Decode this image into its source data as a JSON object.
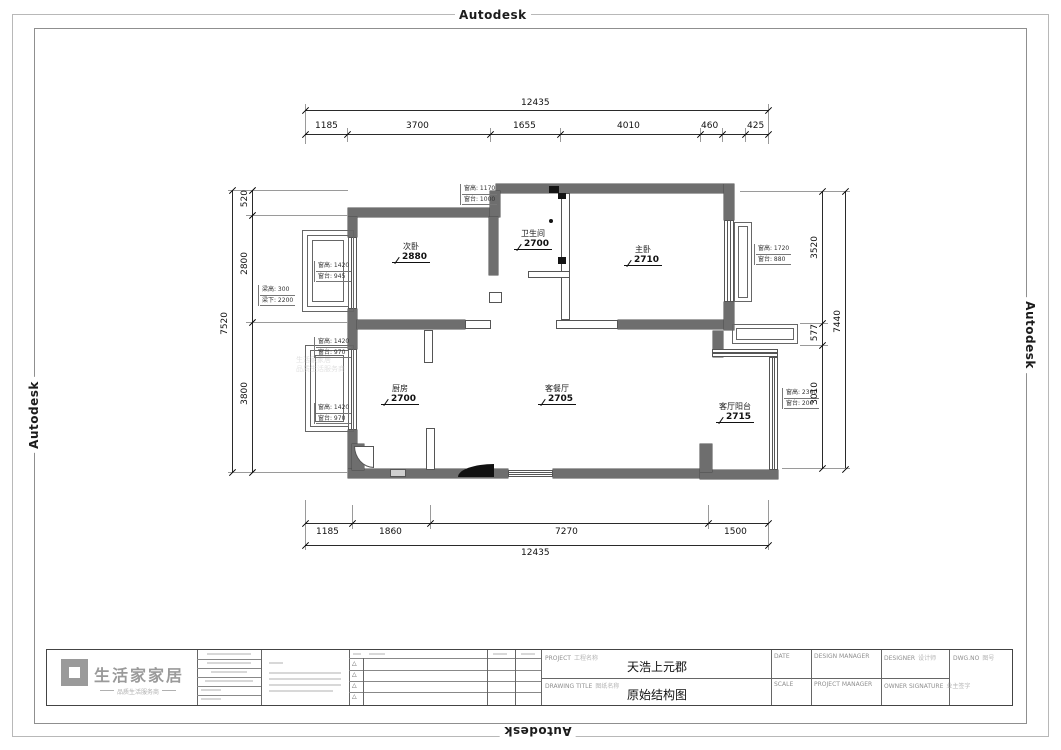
{
  "watermark_text": "Autodesk",
  "plan": {
    "rooms": [
      {
        "name": "次卧",
        "height": "2880"
      },
      {
        "name": "卫生间",
        "height": "2700"
      },
      {
        "name": "主卧",
        "height": "2710"
      },
      {
        "name": "厨房",
        "height": "2700"
      },
      {
        "name": "客餐厅",
        "height": "2705"
      },
      {
        "name": "客厅阳台",
        "height": "2715"
      }
    ],
    "dims": {
      "top": {
        "overall": "12435",
        "segments": [
          "1185",
          "3700",
          "1655",
          "4010",
          "460",
          "425"
        ]
      },
      "bottom": {
        "overall": "12435",
        "segments": [
          "1185",
          "1860",
          "7270",
          "1500"
        ]
      },
      "left": {
        "overall": "7520",
        "segments": [
          "520",
          "2800",
          "3800"
        ]
      },
      "right": {
        "overall": "7440",
        "segments": [
          "3520",
          "577",
          "3010"
        ]
      }
    },
    "annotations": [
      {
        "line1": "窗高: 1170",
        "line2": "窗台: 1000"
      },
      {
        "line1": "窗高: 1420",
        "line2": "窗台: 945"
      },
      {
        "line1": "梁高: 300",
        "line2": "梁下: 2200"
      },
      {
        "line1": "窗高: 1420",
        "line2": "窗台: 970"
      },
      {
        "line1": "窗高: 1420",
        "line2": "窗台: 970"
      },
      {
        "line1": "窗高: 1720",
        "line2": "窗台: 880"
      },
      {
        "line1": "窗高: 2300",
        "line2": "窗台: 200"
      }
    ]
  },
  "title_block": {
    "logo": {
      "name": "生活家家居",
      "tagline": "品质生活服务商"
    },
    "project_label": "PROJECT",
    "project_label_cn": "工程名称",
    "project_value": "天浩上元郡",
    "drawing_title_label": "DRAWING TITLE",
    "drawing_title_label_cn": "图纸名称",
    "drawing_title_value": "原始结构图",
    "date_label": "DATE",
    "design_manager_label": "DESIGN MANAGER",
    "designer_label": "DESIGNER",
    "designer_label_cn": "设计师",
    "scale_label": "SCALE",
    "project_manager_label": "PROJECT MANAGER",
    "owner_signature_label": "OWNER SIGNATURE",
    "owner_signature_label_cn": "业主签字",
    "dwg_no_label": "DWG.NO",
    "dwg_no_label_cn": "图号",
    "revision_marks": [
      "△",
      "△",
      "△",
      "△"
    ]
  },
  "colors": {
    "wall": "#6e6e6e",
    "line": "#2a2a2a",
    "grey_text": "#8f8f8f"
  }
}
